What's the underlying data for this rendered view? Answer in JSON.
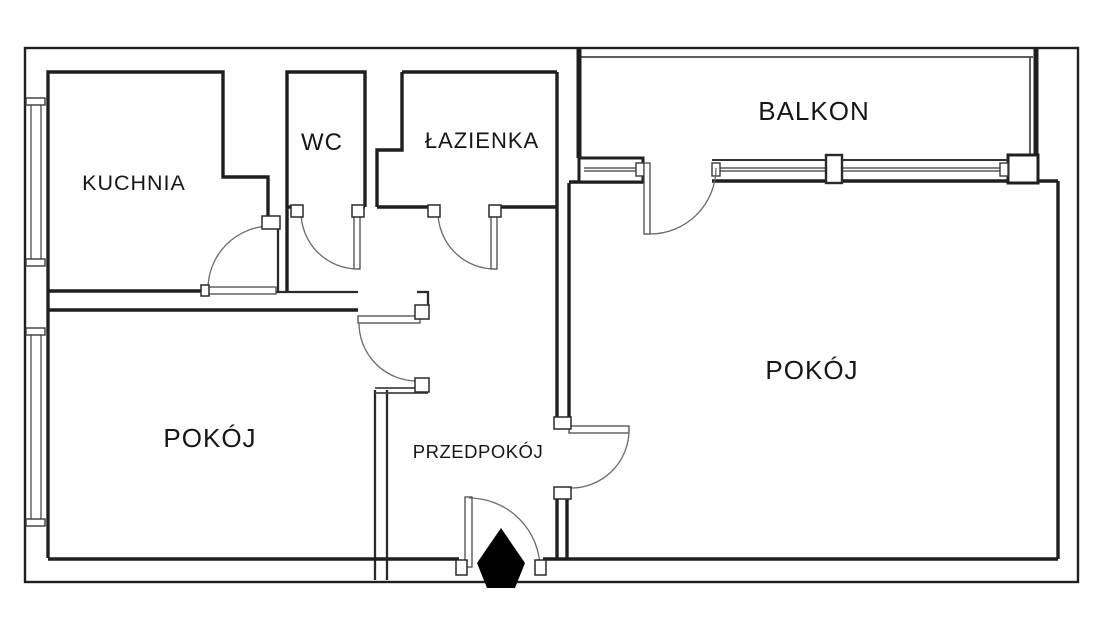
{
  "plan": {
    "type": "apartment-floor-plan",
    "labels": {
      "kuchnia": "KUCHNIA",
      "wc": "WC",
      "lazienka": "ŁAZIENKA",
      "balkon": "BALKON",
      "pokoj_right": "POKÓJ",
      "pokoj_left": "POKÓJ",
      "przedpokoj": "PRZEDPOKÓJ"
    },
    "colors": {
      "wall": "#1f1f1f",
      "thin_line": "#5a5a5a",
      "background": "#ffffff",
      "entrance_marker": "#000000"
    }
  }
}
